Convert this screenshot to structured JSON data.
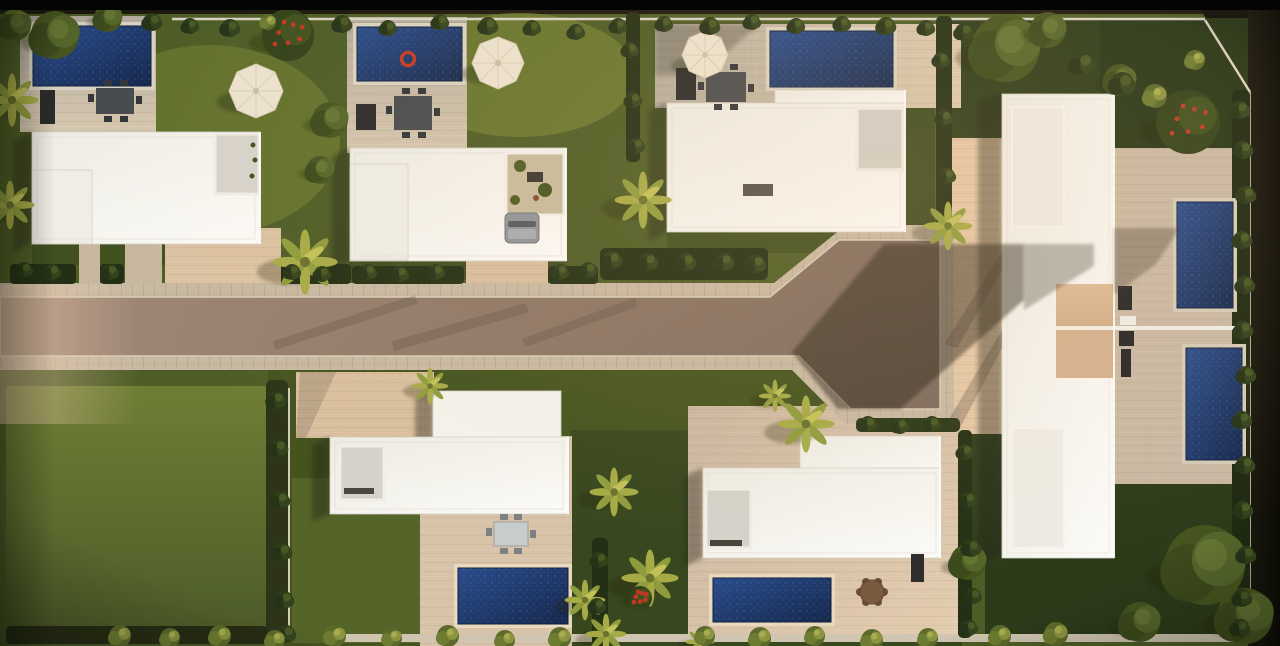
{
  "scene": {
    "type": "architectural-aerial-render",
    "description": "Top-down drone render at golden hour of a modern villa development: white flat-roof villas with private blue pools and lawns around a central east-west road that widens into a paved plaza, a larger twin-unit complex on the right, one vacant grass lot bottom-left",
    "lighting": "low warm sun from the right, long shadows cast to the lower-left",
    "counts": {
      "villas": 6,
      "complex_units": 2,
      "pools": 7,
      "parasols": 3,
      "cars": 1,
      "vacant_lots": 1
    }
  },
  "palette": {
    "letterbox": "#040404",
    "outside_ground": "#1b180d",
    "grass_base": "#4e5d26",
    "grass_bright": "#6f7e35",
    "grass_dark": "#2e3d1b",
    "road_asphalt": "#8d7767",
    "road_shadow": "#262119",
    "sidewalk": "#c8b9a3",
    "terrace_paving": "#c3bbab",
    "court_sunlit": "#e0c5a3",
    "building_white": "#f9f8f4",
    "roof_inset": "#d6d2ca",
    "pool_water": "#20407c",
    "pool_deep": "#16284d",
    "hedge": "#243015",
    "palm_frond": "#a6ab46",
    "umbrella": "#ece3d0",
    "float_ring_red": "#c23b28",
    "car_gray": "#8f949a",
    "wall_white": "#d8d2c4"
  },
  "vegetation": {
    "palms": [
      [
        305,
        262,
        32
      ],
      [
        12,
        100,
        26
      ],
      [
        10,
        205,
        24
      ],
      [
        643,
        200,
        28
      ],
      [
        948,
        226,
        24
      ],
      [
        806,
        424,
        28
      ],
      [
        775,
        396,
        16
      ],
      [
        614,
        492,
        24
      ],
      [
        650,
        578,
        28
      ],
      [
        606,
        634,
        20
      ],
      [
        430,
        386,
        18
      ],
      [
        700,
        642,
        14
      ],
      [
        585,
        600,
        20
      ]
    ],
    "trees": [
      [
        1205,
        565,
        40
      ],
      [
        1245,
        616,
        28
      ],
      [
        1140,
        622,
        20
      ],
      [
        968,
        562,
        18
      ],
      [
        1006,
        48,
        34
      ],
      [
        1048,
        30,
        18
      ],
      [
        55,
        35,
        24
      ],
      [
        15,
        25,
        16
      ],
      [
        108,
        18,
        14
      ],
      [
        1120,
        80,
        16
      ],
      [
        330,
        120,
        18
      ],
      [
        320,
        170,
        14
      ]
    ],
    "flower_trees": [
      [
        288,
        35,
        26
      ],
      [
        1188,
        122,
        32
      ],
      [
        640,
        598,
        12
      ]
    ],
    "shrubs_dark": [
      [
        152,
        22,
        9
      ],
      [
        190,
        26,
        8
      ],
      [
        230,
        28,
        9
      ],
      [
        342,
        24,
        9
      ],
      [
        388,
        28,
        8
      ],
      [
        440,
        22,
        8
      ],
      [
        488,
        26,
        9
      ],
      [
        532,
        28,
        8
      ],
      [
        576,
        32,
        8
      ],
      [
        618,
        26,
        8
      ],
      [
        664,
        24,
        8
      ],
      [
        710,
        26,
        9
      ],
      [
        752,
        22,
        8
      ],
      [
        796,
        26,
        8
      ],
      [
        842,
        24,
        8
      ],
      [
        886,
        26,
        9
      ],
      [
        926,
        28,
        8
      ],
      [
        964,
        32,
        9
      ],
      [
        1082,
        64,
        12
      ],
      [
        1122,
        84,
        12
      ],
      [
        630,
        50,
        8
      ],
      [
        633,
        100,
        8
      ],
      [
        636,
        146,
        8
      ],
      [
        941,
        60,
        8
      ],
      [
        944,
        118,
        8
      ],
      [
        947,
        176,
        8
      ],
      [
        276,
        400,
        9
      ],
      [
        278,
        448,
        9
      ],
      [
        280,
        500,
        9
      ],
      [
        282,
        552,
        9
      ],
      [
        284,
        600,
        9
      ],
      [
        286,
        634,
        9
      ],
      [
        599,
        560,
        8
      ],
      [
        597,
        606,
        8
      ],
      [
        965,
        452,
        8
      ],
      [
        968,
        500,
        8
      ],
      [
        971,
        548,
        9
      ],
      [
        973,
        596,
        8
      ],
      [
        969,
        628,
        8
      ],
      [
        1240,
        110,
        9
      ],
      [
        1243,
        150,
        9
      ],
      [
        1246,
        195,
        9
      ],
      [
        1242,
        240,
        9
      ],
      [
        1245,
        285,
        9
      ],
      [
        1243,
        330,
        9
      ],
      [
        1246,
        375,
        9
      ],
      [
        1242,
        420,
        9
      ],
      [
        1245,
        465,
        9
      ],
      [
        1243,
        510,
        9
      ],
      [
        1246,
        555,
        9
      ],
      [
        1242,
        598,
        9
      ],
      [
        1240,
        628,
        9
      ],
      [
        24,
        270,
        8
      ],
      [
        52,
        272,
        8
      ],
      [
        110,
        272,
        8
      ],
      [
        292,
        272,
        8
      ],
      [
        322,
        274,
        8
      ],
      [
        368,
        272,
        8
      ],
      [
        400,
        274,
        8
      ],
      [
        436,
        272,
        8
      ],
      [
        560,
        272,
        8
      ],
      [
        588,
        270,
        8
      ],
      [
        612,
        260,
        9
      ],
      [
        648,
        262,
        9
      ],
      [
        686,
        262,
        9
      ],
      [
        724,
        262,
        9
      ],
      [
        756,
        264,
        9
      ],
      [
        868,
        424,
        8
      ],
      [
        900,
        426,
        8
      ],
      [
        932,
        424,
        8
      ]
    ],
    "shrubs_light": [
      [
        120,
        636,
        11
      ],
      [
        170,
        638,
        10
      ],
      [
        220,
        636,
        11
      ],
      [
        275,
        640,
        10
      ],
      [
        335,
        636,
        11
      ],
      [
        392,
        638,
        10
      ],
      [
        448,
        636,
        11
      ],
      [
        505,
        640,
        10
      ],
      [
        560,
        638,
        11
      ],
      [
        705,
        636,
        10
      ],
      [
        760,
        638,
        11
      ],
      [
        815,
        636,
        10
      ],
      [
        872,
        640,
        11
      ],
      [
        928,
        638,
        10
      ],
      [
        1000,
        636,
        11
      ],
      [
        1056,
        634,
        12
      ],
      [
        268,
        22,
        8
      ],
      [
        1155,
        96,
        12
      ],
      [
        1195,
        60,
        10
      ]
    ]
  }
}
